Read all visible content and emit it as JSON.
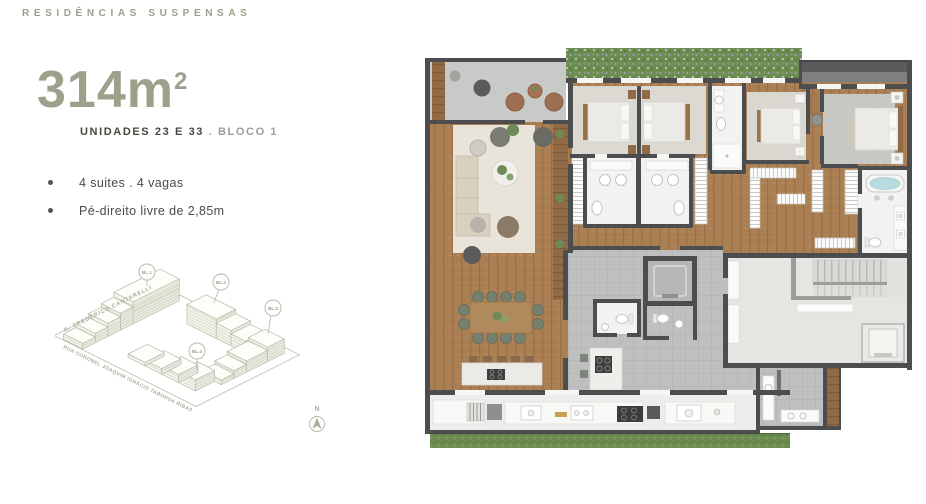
{
  "header": {
    "title": "RESIDÊNCIAS SUSPENSAS"
  },
  "unit": {
    "area": "314m",
    "area_sup": "2",
    "units_label": "UNIDADES 23 E 33",
    "block_label": ". BLOCO 1",
    "features": [
      "4 suites . 4 vagas",
      "Pé-direito livre de 2,85m"
    ]
  },
  "site_plan": {
    "street_top": "R. FREDERICO CANTARELLI",
    "street_bottom": "RUA CORONEL JOAQUIM IGNÁCIO TABORDA RIBAS",
    "blocks": [
      "BL.1",
      "BL.2",
      "BL.3",
      "BL.4"
    ],
    "compass": "N"
  },
  "colors": {
    "accent_sage": "#9ba18a",
    "text_dark": "#47473f",
    "text_gray": "#9d9d97",
    "plan_wall": "#4c4d4e",
    "wood_floor": "#ab7f54",
    "tile_gray": "#bdc0be",
    "hedge_green": "#6d8c51"
  }
}
